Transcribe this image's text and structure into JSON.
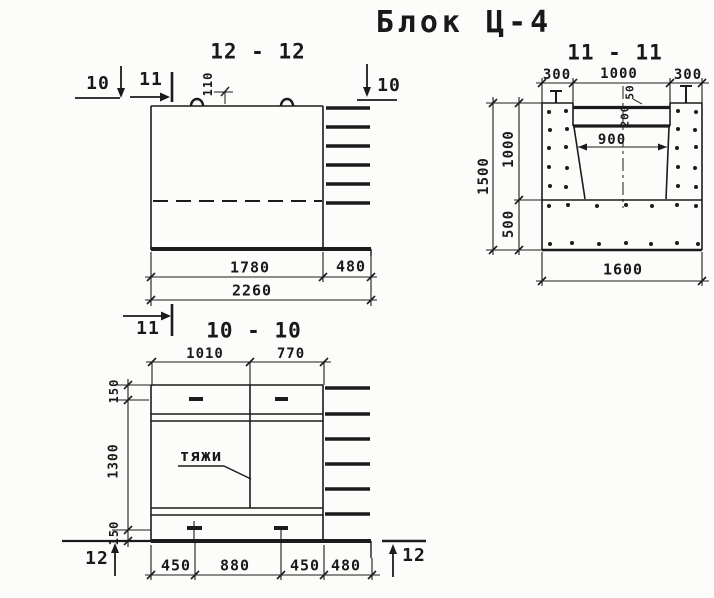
{
  "drawing_title": "Блок Ц-4",
  "colors": {
    "ink": "#1b1b1b",
    "paper": "#fcfcfa"
  },
  "sections": {
    "s1212": {
      "title": "12 - 12",
      "dims": {
        "width_main": "1780",
        "width_ledge": "480",
        "width_total": "2260",
        "loop_offset": "110"
      },
      "markers": {
        "cut10_left": "10",
        "cut11_top": "11",
        "cut10_right": "10",
        "cut11_bottom": "11"
      }
    },
    "s1111": {
      "title": "11 - 11",
      "dims": {
        "top_left": "300",
        "top_middle": "1000",
        "top_right": "300",
        "wall_lip": "50",
        "wall_step": "200",
        "trough_width": "900",
        "height_total": "1500",
        "height_upper": "1000",
        "height_lower": "500",
        "width_total": "1600"
      }
    },
    "s1010": {
      "title": "10 - 10",
      "tie_label": "тяжи",
      "dims": {
        "top_left": "1010",
        "top_right": "770",
        "side_top": "150",
        "side_middle": "1300",
        "side_bottom": "150",
        "bottom_1": "450",
        "bottom_2": "880",
        "bottom_3": "450",
        "bottom_4": "480"
      },
      "markers": {
        "cut12_left": "12",
        "cut12_right": "12"
      }
    }
  }
}
